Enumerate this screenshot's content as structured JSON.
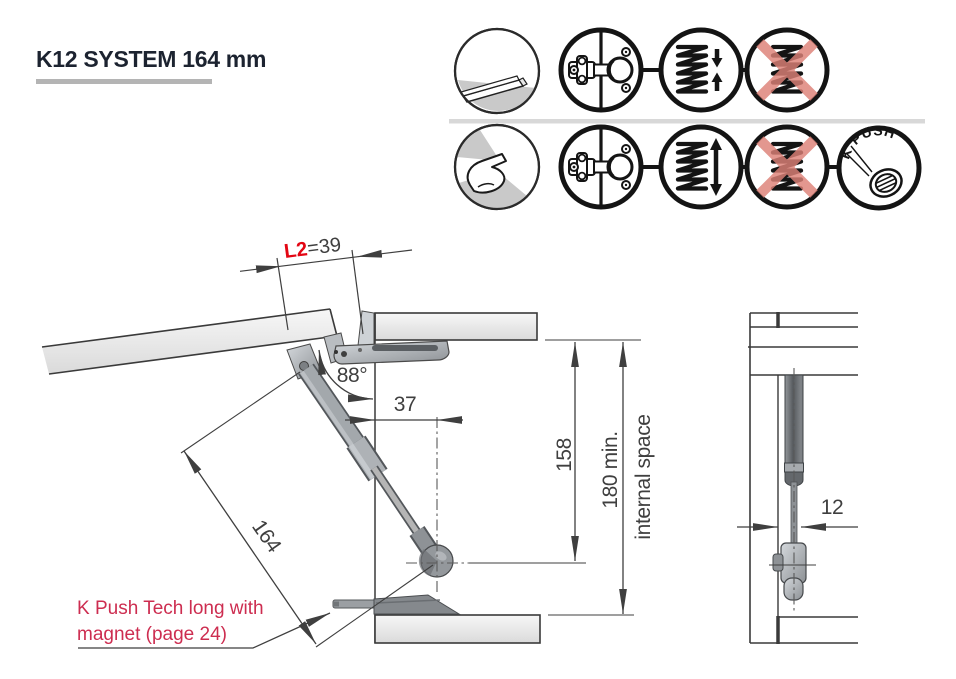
{
  "page": {
    "title": "K12 SYSTEM 164 mm"
  },
  "icons": {
    "row1": [
      "panel-profile",
      "hinge",
      "spring-compression",
      "spring-crossed-out"
    ],
    "row2": [
      "press-to-open",
      "hinge",
      "spring-extension",
      "spring-crossed-out",
      "k-push"
    ],
    "kpush_label": "K`PUSH"
  },
  "diagram": {
    "dims": {
      "l2_label": "L2",
      "l2_value": "=39",
      "opening_angle": "88°",
      "depth": "37",
      "height_inner": "158",
      "height_min": "180 min.",
      "height_min_caption": "internal space",
      "piston_length": "164",
      "side_offset": "12"
    },
    "note_line1": "K Push Tech long with",
    "note_line2": "magnet (page 24)"
  },
  "colors": {
    "accent_red": "#e30613",
    "note_red": "#cd2d50",
    "cross_red": "#dd8177",
    "title_color": "#1c2330",
    "line_color": "#3f3f3f"
  }
}
